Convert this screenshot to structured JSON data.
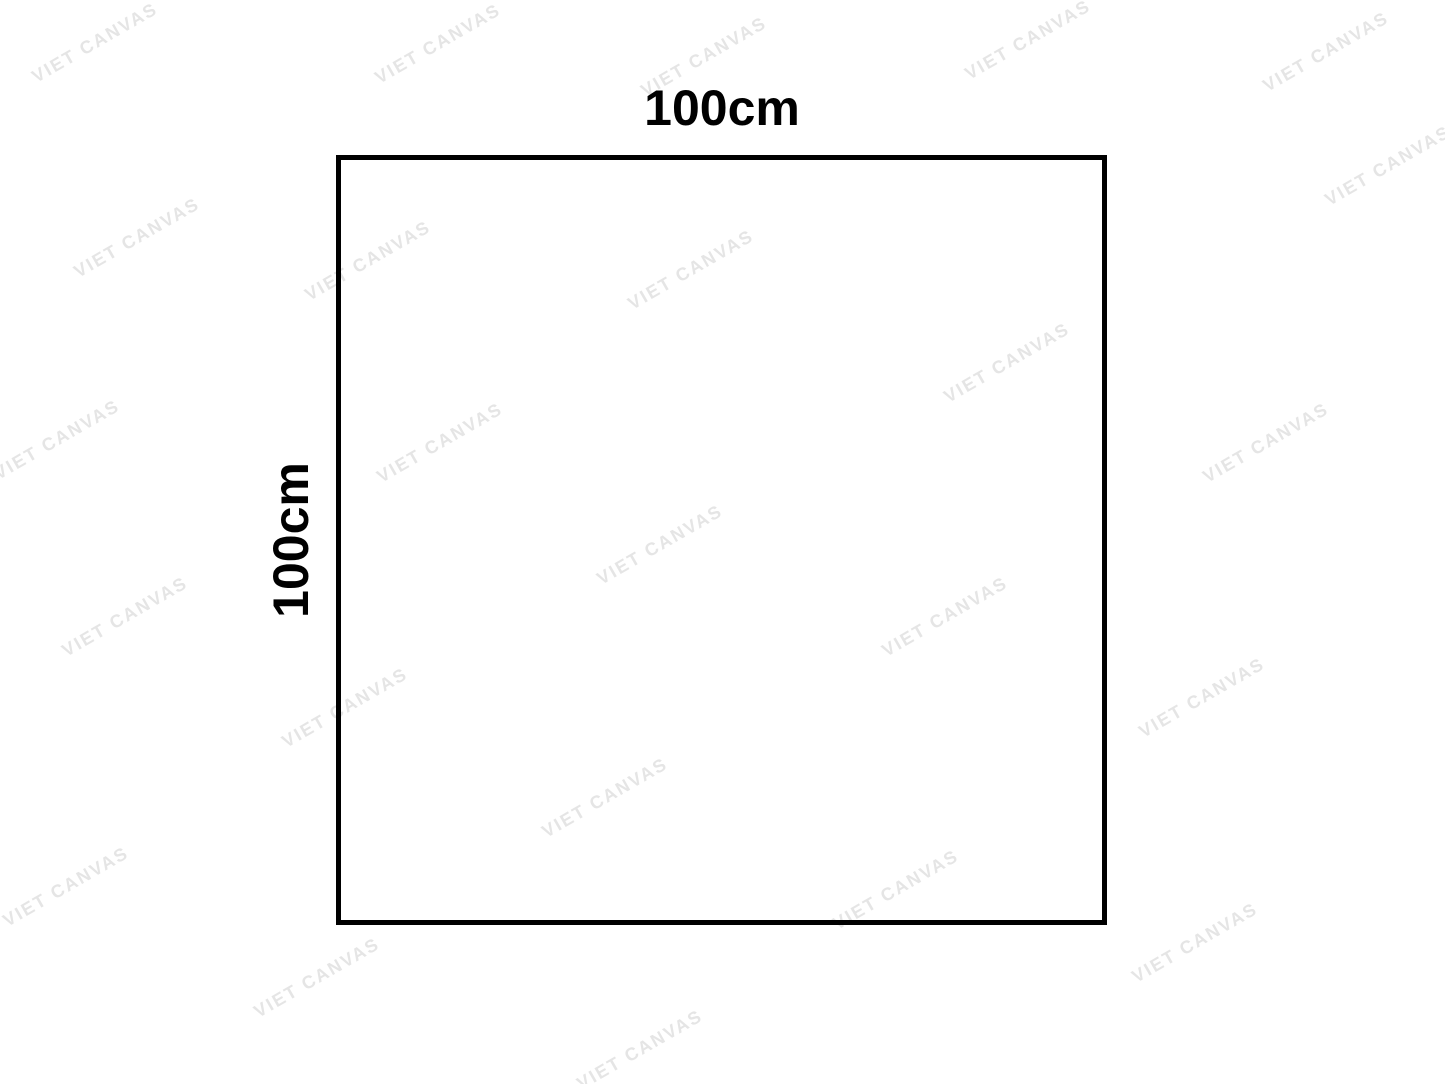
{
  "diagram": {
    "shape": "square",
    "width_label": "100cm",
    "height_label": "100cm"
  },
  "watermark": {
    "text": "VIET CANVAS",
    "color": "#e5e5e5",
    "angle_deg": -30,
    "positions": [
      [
        95,
        43
      ],
      [
        438,
        44
      ],
      [
        704,
        57
      ],
      [
        1028,
        40
      ],
      [
        1326,
        52
      ],
      [
        1388,
        166
      ],
      [
        137,
        238
      ],
      [
        368,
        261
      ],
      [
        691,
        270
      ],
      [
        1007,
        363
      ],
      [
        57,
        440
      ],
      [
        440,
        443
      ],
      [
        1266,
        443
      ],
      [
        660,
        545
      ],
      [
        125,
        617
      ],
      [
        945,
        617
      ],
      [
        345,
        708
      ],
      [
        1202,
        698
      ],
      [
        605,
        798
      ],
      [
        66,
        887
      ],
      [
        896,
        890
      ],
      [
        317,
        978
      ],
      [
        1195,
        943
      ],
      [
        640,
        1050
      ]
    ]
  },
  "colors": {
    "background": "#ffffff",
    "outline": "#000000",
    "label": "#000000"
  }
}
